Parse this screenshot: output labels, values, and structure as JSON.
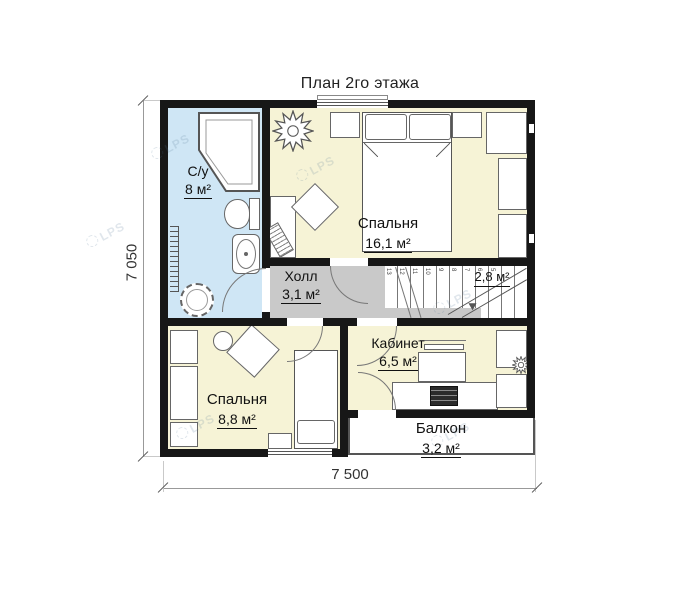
{
  "title": "План 2го этажа",
  "rooms": {
    "bathroom": {
      "name": "С/у",
      "area": "8 м²"
    },
    "bedroom_large": {
      "name": "Спальня",
      "area": "16,1 м²"
    },
    "hall": {
      "name": "Холл",
      "area": "3,1 м²"
    },
    "stair_landing": {
      "area": "2,8 м²"
    },
    "office": {
      "name": "Кабинет",
      "area": "6,5 м²"
    },
    "bedroom_small": {
      "name": "Спальня",
      "area": "8,8 м²"
    },
    "balcony": {
      "name": "Балкон",
      "area": "3,2 м²"
    }
  },
  "dimensions": {
    "horizontal": "7 500",
    "vertical": "7 050"
  },
  "stairs": {
    "steps": [
      "13",
      "12",
      "11",
      "10",
      "9",
      "8",
      "7",
      "6",
      "5"
    ]
  },
  "watermark": {
    "text": "LPS"
  },
  "colors": {
    "wall": "#171717",
    "bathroom_fill": "#cfe6f5",
    "room_fill": "#f6f3d6",
    "hall_fill": "#c9c9c9",
    "furniture_stroke": "#666666",
    "dimension_line": "#999999"
  }
}
